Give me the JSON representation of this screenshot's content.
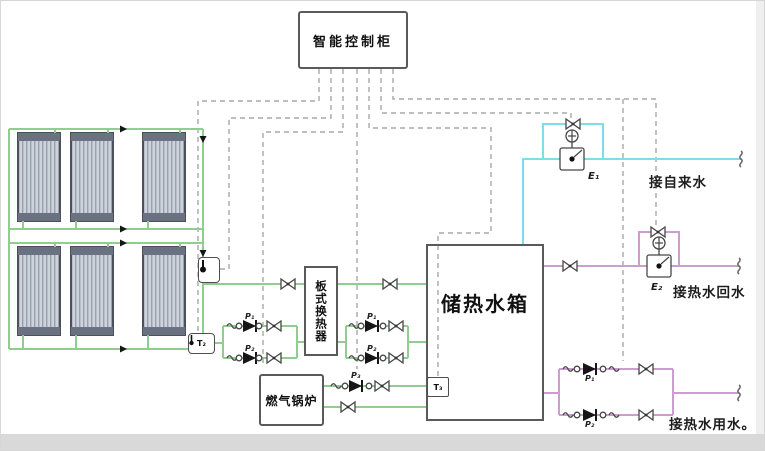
{
  "diagram_title": "太阳能集热-储热水箱智能控制系统图",
  "colors": {
    "solar_loop": "#8fce8f",
    "tap_water": "#7fdce8",
    "hot_water": "#cf9ccf",
    "control_dashed": "#a8a8a8",
    "outline": "#5a5a5a"
  },
  "control_cabinet": {
    "label": "智能控制柜"
  },
  "heat_exchanger": {
    "label": "板式换热器"
  },
  "boiler": {
    "label": "燃气锅炉"
  },
  "tank": {
    "label": "储热水箱"
  },
  "sensors": {
    "t2": "T₂",
    "t3": "T₃"
  },
  "valves": {
    "e1": "E₁",
    "e2": "E₂"
  },
  "pumps": {
    "solar_1": "P₁",
    "solar_2": "P₂",
    "hx_1": "P₁",
    "hx_2": "P₂",
    "boiler": "P₃",
    "supply_1": "P₁",
    "supply_2": "P₂"
  },
  "connections": {
    "tap_in": "接自来水",
    "return_in": "接热水回水",
    "supply_out": "接热水用水",
    "supply_suffix": "。"
  },
  "icons": {
    "sensor": "thermometer-icon",
    "pump": "pump-icon",
    "valve": "gate-valve-icon",
    "motor_valve": "motorized-valve-icon",
    "flex": "flex-connector-icon",
    "break": "pipe-break-icon"
  }
}
